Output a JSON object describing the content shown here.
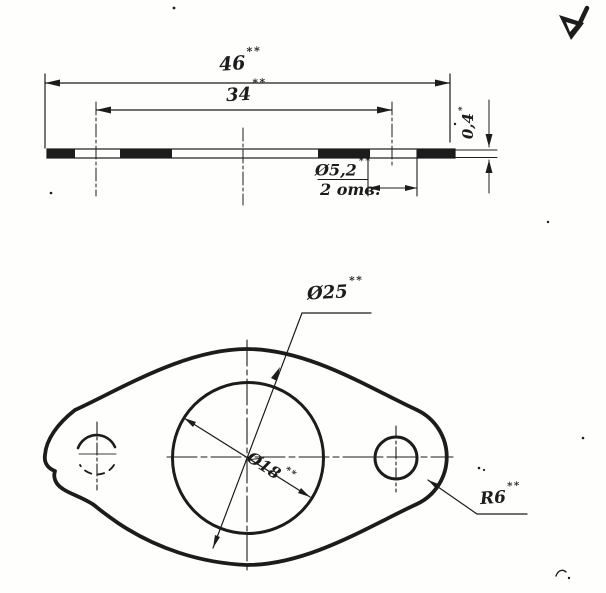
{
  "palette": {
    "paper": "#fefefd",
    "ink": "#1c1c1c"
  },
  "surface_finish": {
    "icon_name": "surface-roughness-check-icon"
  },
  "section_view": {
    "dim_length": {
      "value": "46",
      "stars": "**"
    },
    "dim_hole_spacing": {
      "value": "34",
      "stars": "**"
    },
    "dim_thickness": {
      "value": "0,4",
      "stars": "*"
    },
    "dim_bolt_hole": {
      "value": "Ø5,2",
      "stars": "**",
      "note": "2 отв."
    }
  },
  "plan_view": {
    "dim_outer_diameter": {
      "value": "Ø25",
      "stars": "**"
    },
    "dim_center_hole": {
      "value": "Ø18",
      "stars": "**"
    },
    "dim_end_radius": {
      "value": "R6",
      "stars": "**"
    }
  }
}
